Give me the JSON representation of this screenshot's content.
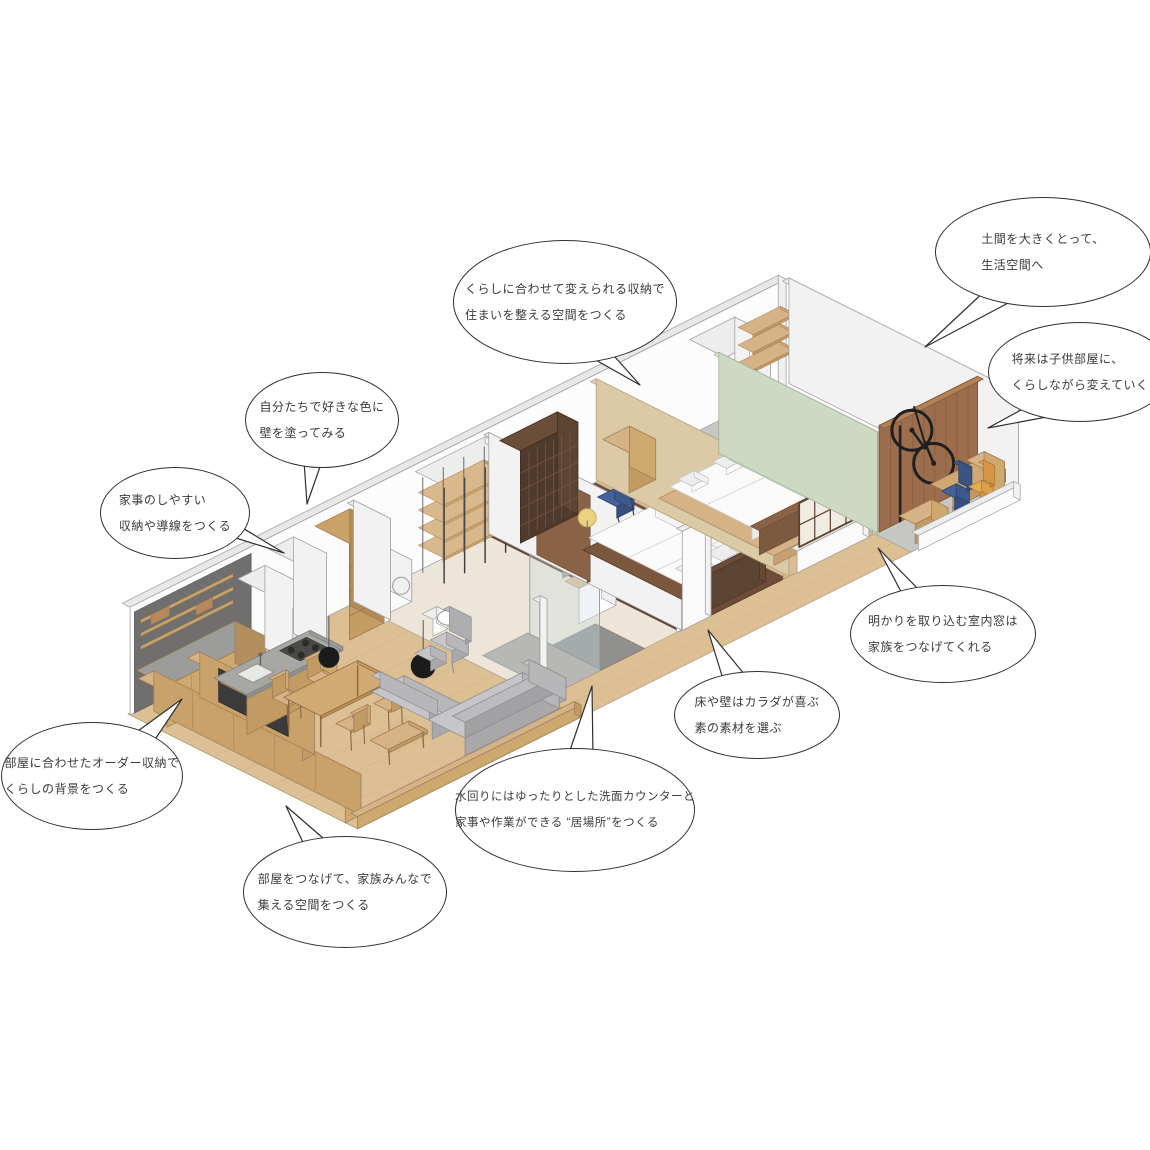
{
  "bubbles": [
    {
      "id": "doma",
      "lines": [
        "土間を大きくとって、",
        "生活空間へ"
      ]
    },
    {
      "id": "kids-room",
      "lines": [
        "将来は子供部屋に、",
        "くらしながら変えていく"
      ]
    },
    {
      "id": "closet",
      "lines": [
        "くらしに合わせて変えられる収納で",
        "住まいを整える空間をつくる"
      ]
    },
    {
      "id": "paint-wall",
      "lines": [
        "自分たちで好きな色に",
        "壁を塗ってみる"
      ]
    },
    {
      "id": "housework",
      "lines": [
        "家事のしやすい",
        "収納や導線をつくる"
      ]
    },
    {
      "id": "order-storage",
      "lines": [
        "部屋に合わせたオーダー収納で",
        "くらしの背景をつくる"
      ]
    },
    {
      "id": "connect-rooms",
      "lines": [
        "部屋をつなげて、家族みんなで",
        "集える空間をつくる"
      ]
    },
    {
      "id": "water-area",
      "lines": [
        "水回りにはゆったりとした洗面カウンターと",
        "家事や作業ができる “居場所”をつくる"
      ]
    },
    {
      "id": "materials",
      "lines": [
        "床や壁はカラダが喜ぶ",
        "素の素材を選ぶ"
      ]
    },
    {
      "id": "interior-window",
      "lines": [
        "明かりを取り込む室内窓は",
        "家族をつなげてくれる"
      ]
    }
  ],
  "colors": {
    "floor_wood_light": "#ddbf94",
    "floor_wood_dark": "#6e4c37",
    "floor_concrete": "#c6c6c2",
    "wood_furniture": "#d6b386",
    "bookshelf_brown": "#5c4433",
    "doma_wall_brown": "#9c6e4d",
    "sofa_gray": "#b7b7b9",
    "green_wall": "#cdd9c3",
    "blue_chair": "#3d588b",
    "orange_chair": "#dc9f4a",
    "kitchen_wall_gray": "#706f6d",
    "tv_panel": "#3b3b3b",
    "lamp_yellow": "#ead27f",
    "wall_white": "#ffffff"
  }
}
